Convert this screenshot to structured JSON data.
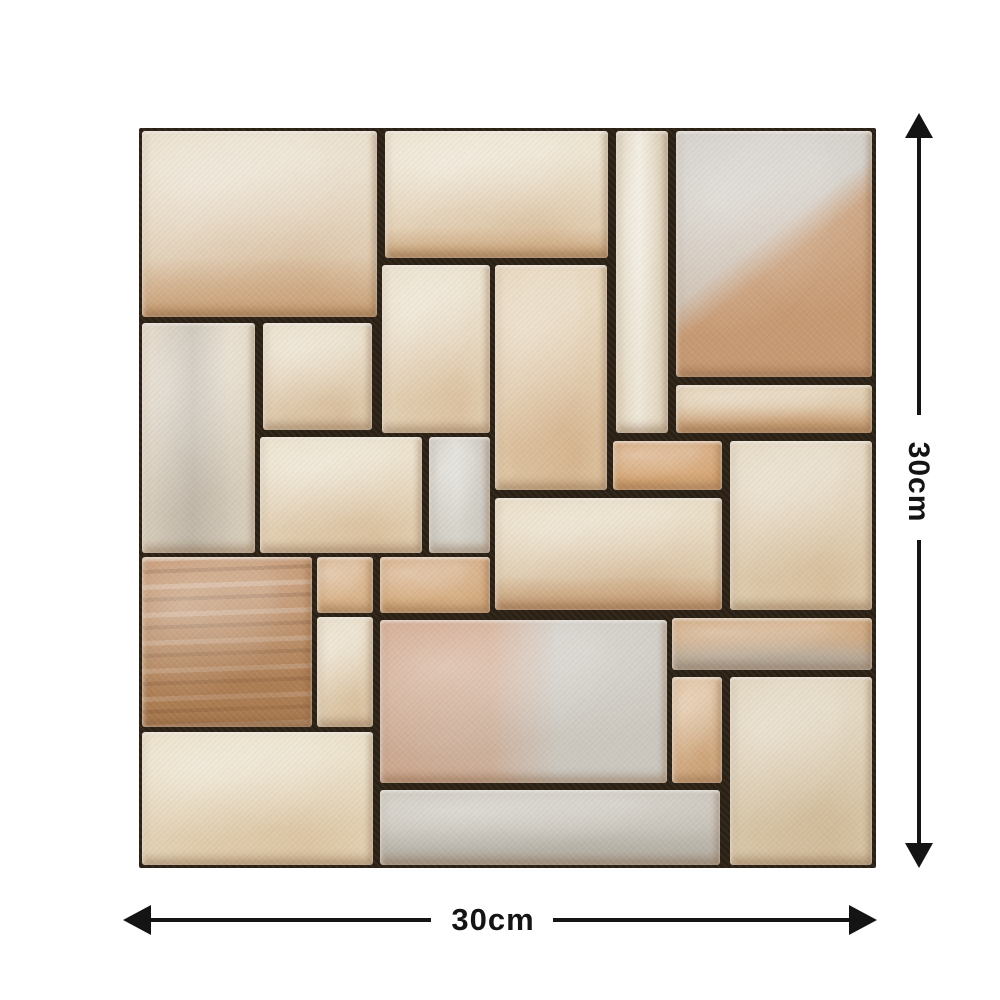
{
  "page": {
    "background": "#ffffff"
  },
  "tile_panel": {
    "grout_color": "#2a2014",
    "border_color": "#2a2014",
    "description_colors": {
      "cream": "#e8dcc5",
      "tan": "#c89b70",
      "gray": "#c8c4bb",
      "brown": "#c08d63"
    }
  },
  "dimensions": {
    "height_label": "30cm",
    "width_label": "30cm",
    "arrow_color": "#141414"
  },
  "stones": [
    {
      "id": "top-left-large",
      "x": 3,
      "y": 3,
      "w": 235,
      "h": 186,
      "pattern": "hband",
      "c1": "#e7dbc6",
      "c2": "#c79c72",
      "split": 68
    },
    {
      "id": "top-mid",
      "x": 246,
      "y": 3,
      "w": 223,
      "h": 127,
      "pattern": "hband",
      "c1": "#eadfc9",
      "c2": "#cba47a",
      "split": 76
    },
    {
      "id": "top-narrow-tall",
      "x": 477,
      "y": 3,
      "w": 52,
      "h": 302,
      "pattern": "vstreak",
      "c1": "#d9cbb1",
      "c2": "#efe8d9"
    },
    {
      "id": "top-right-large",
      "x": 537,
      "y": 3,
      "w": 196,
      "h": 246,
      "pattern": "diag",
      "c1": "#cecac3",
      "c2": "#c69972"
    },
    {
      "id": "right-thin-band",
      "x": 537,
      "y": 257,
      "w": 196,
      "h": 48,
      "pattern": "hband",
      "c1": "#ddc8a8",
      "c2": "#c89b70",
      "split": 45
    },
    {
      "id": "mid-cream-a",
      "x": 243,
      "y": 137,
      "w": 108,
      "h": 168,
      "pattern": "flat",
      "c1": "#e8dcc5",
      "c2": "#cfa87d"
    },
    {
      "id": "mid-cream-tall",
      "x": 356,
      "y": 137,
      "w": 112,
      "h": 225,
      "pattern": "flat",
      "c1": "#e3d0b2",
      "c2": "#c99b6e"
    },
    {
      "id": "left-small-square",
      "x": 124,
      "y": 195,
      "w": 109,
      "h": 107,
      "pattern": "flat",
      "c1": "#e6d9c1",
      "c2": "#cba57b"
    },
    {
      "id": "left-tall",
      "x": 3,
      "y": 195,
      "w": 113,
      "h": 230,
      "pattern": "vstreak",
      "c1": "#e2d7c3",
      "c2": "#bfb6a8"
    },
    {
      "id": "mid-left-block",
      "x": 121,
      "y": 309,
      "w": 162,
      "h": 116,
      "pattern": "flat",
      "c1": "#e8dcc4",
      "c2": "#cda77c"
    },
    {
      "id": "mid-gray-narrow",
      "x": 290,
      "y": 309,
      "w": 61,
      "h": 116,
      "pattern": "vstreak",
      "c1": "#c8c4bb",
      "c2": "#d8d5cd"
    },
    {
      "id": "mid-orange-small",
      "x": 474,
      "y": 313,
      "w": 109,
      "h": 49,
      "pattern": "flat",
      "c1": "#cf9b68",
      "c2": "#e0b98b"
    },
    {
      "id": "right-mid-large",
      "x": 591,
      "y": 313,
      "w": 142,
      "h": 169,
      "pattern": "flat",
      "c1": "#e1d3ba",
      "c2": "#cdab80"
    },
    {
      "id": "center-wide",
      "x": 356,
      "y": 370,
      "w": 227,
      "h": 112,
      "pattern": "hband",
      "c1": "#e5d7bc",
      "c2": "#c49a72",
      "split": 70
    },
    {
      "id": "small-tan-square",
      "x": 178,
      "y": 429,
      "w": 56,
      "h": 56,
      "pattern": "flat",
      "c1": "#d2a87c",
      "c2": "#e3c39b"
    },
    {
      "id": "small-tan-wide",
      "x": 241,
      "y": 429,
      "w": 110,
      "h": 56,
      "pattern": "flat",
      "c1": "#cfa173",
      "c2": "#e0bf97"
    },
    {
      "id": "left-brown-veined",
      "x": 3,
      "y": 429,
      "w": 170,
      "h": 170,
      "pattern": "veins",
      "c1": "#c08d63",
      "c2": "#a97a50"
    },
    {
      "id": "mid-cream-narrow",
      "x": 178,
      "y": 489,
      "w": 56,
      "h": 110,
      "pattern": "flat",
      "c1": "#e5d8bf",
      "c2": "#cda97e"
    },
    {
      "id": "bottom-center-large",
      "x": 241,
      "y": 492,
      "w": 287,
      "h": 163,
      "pattern": "vsplit",
      "c1": "#cda083",
      "c2": "#cbc7bf"
    },
    {
      "id": "right-band-low",
      "x": 533,
      "y": 490,
      "w": 200,
      "h": 52,
      "pattern": "hband",
      "c1": "#c99d6f",
      "c2": "#b5b1a9",
      "split": 42
    },
    {
      "id": "low-narrow-tan",
      "x": 533,
      "y": 549,
      "w": 50,
      "h": 106,
      "pattern": "flat",
      "c1": "#d9b68f",
      "c2": "#c09264"
    },
    {
      "id": "bottom-right-large",
      "x": 591,
      "y": 549,
      "w": 142,
      "h": 188,
      "pattern": "flat",
      "c1": "#ddcfb5",
      "c2": "#c5a87e"
    },
    {
      "id": "bottom-left",
      "x": 3,
      "y": 604,
      "w": 231,
      "h": 133,
      "pattern": "flat",
      "c1": "#e8dcc2",
      "c2": "#cfae85"
    },
    {
      "id": "bottom-gray-band",
      "x": 241,
      "y": 662,
      "w": 340,
      "h": 75,
      "pattern": "hband",
      "c1": "#c6c1b7",
      "c2": "#b3aea4",
      "split": 50
    }
  ]
}
